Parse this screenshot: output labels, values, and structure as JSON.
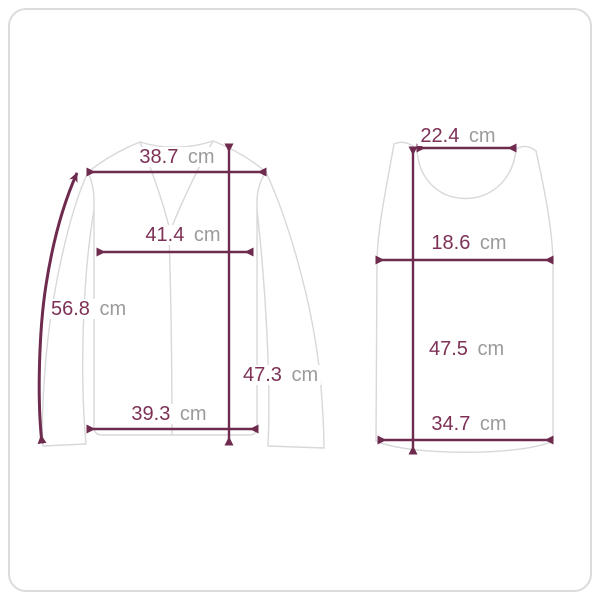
{
  "colors": {
    "background": "#ffffff",
    "frame_border": "#dcdcdc",
    "garment_outline": "#d8d8db",
    "measure_line": "#6e2b4d",
    "value_text": "#7d3156",
    "unit_text": "#9b9b9b"
  },
  "diagram": {
    "type": "garment-size-guide",
    "unit": "cm",
    "garments": [
      {
        "name": "long-sleeve-v-neck-top",
        "measurements": {
          "shoulder_width": {
            "value": "38.7",
            "unit": "cm"
          },
          "chest_width": {
            "value": "41.4",
            "unit": "cm"
          },
          "sleeve_length": {
            "value": "56.8",
            "unit": "cm"
          },
          "total_length": {
            "value": "47.3",
            "unit": "cm"
          },
          "hem_width": {
            "value": "39.3",
            "unit": "cm"
          }
        }
      },
      {
        "name": "tank-top",
        "measurements": {
          "neck_width": {
            "value": "22.4",
            "unit": "cm"
          },
          "chest_width": {
            "value": "18.6",
            "unit": "cm"
          },
          "total_length": {
            "value": "47.5",
            "unit": "cm"
          },
          "hem_width": {
            "value": "34.7",
            "unit": "cm"
          }
        }
      }
    ]
  }
}
